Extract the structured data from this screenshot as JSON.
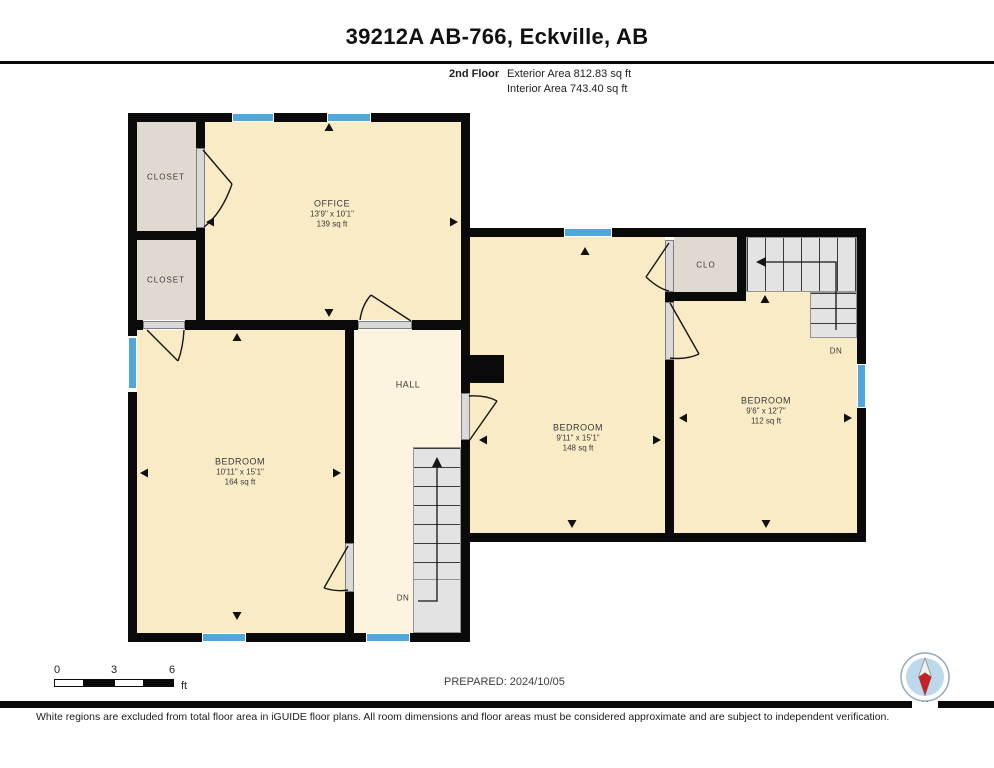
{
  "header": {
    "title": "39212A AB-766, Eckville, AB",
    "floor_label": "2nd Floor",
    "exterior_area": "Exterior Area 812.83 sq ft",
    "interior_area": "Interior Area 743.40 sq ft"
  },
  "rooms": {
    "office": {
      "name": "OFFICE",
      "dims": "13'9\" x 10'1\"",
      "area": "139 sq ft"
    },
    "closet1": {
      "name": "CLOSET"
    },
    "closet2": {
      "name": "CLOSET"
    },
    "bedroom_left": {
      "name": "BEDROOM",
      "dims": "10'11\" x 15'1\"",
      "area": "164 sq ft"
    },
    "hall": {
      "name": "HALL"
    },
    "bedroom_middle": {
      "name": "BEDROOM",
      "dims": "9'11\" x 15'1\"",
      "area": "148 sq ft"
    },
    "clo": {
      "name": "CLO"
    },
    "bedroom_right": {
      "name": "BEDROOM",
      "dims": "9'6\" x 12'7\"",
      "area": "112 sq ft"
    },
    "stair_down_hall": "DN",
    "stair_down_right": "DN"
  },
  "scale_bar": {
    "tick0": "0",
    "tick1": "3",
    "tick2": "6",
    "unit": "ft"
  },
  "footer": {
    "prepared": "PREPARED: 2024/10/05",
    "disclaimer": "White regions are excluded from total floor area in iGUIDE floor plans. All room dimensions and floor areas must be considered approximate and are subject to independent verification.",
    "compass_label": "N"
  },
  "colors": {
    "wall": "#0a0a0a",
    "room_fill": "#F9EBC6",
    "hall_fill": "#FCF4DE",
    "closet_fill": "#DFD9D0",
    "window": "#4FA7DB",
    "stairs_fill": "#E3E3E3",
    "compass_red": "#C42126",
    "compass_inner": "#BCD9EB"
  }
}
